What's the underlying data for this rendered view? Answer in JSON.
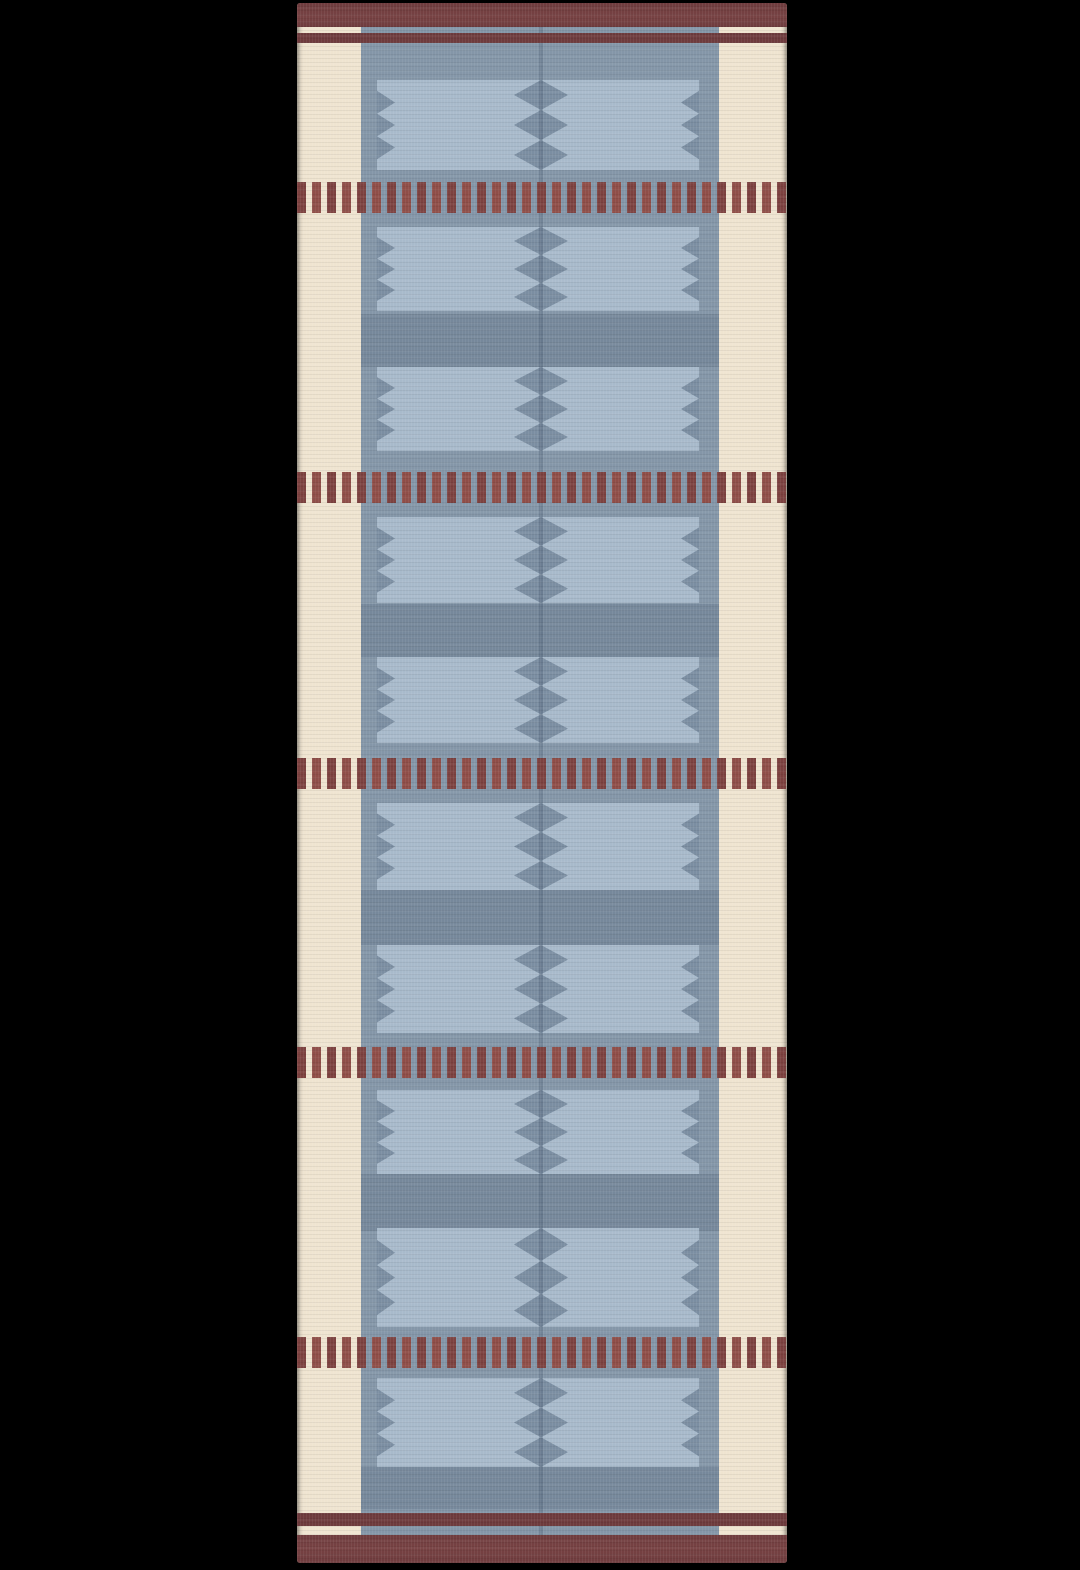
{
  "scene": {
    "description": "Product photo of a flat-woven kilim-style runner rug, shown full-length on a black background. The rug has cream side borders, a slate-blue centre field filled with light-blue flag motifs that have zigzag edges and a centre chain of dark diamonds, horizontal rows of maroon dashes, thin maroon stripes and solid maroon bands at both ends.",
    "background_color": "#000000"
  },
  "rug": {
    "left": 297,
    "top": 3,
    "width": 490,
    "height": 1560,
    "colors": {
      "cream": "#efe4d0",
      "panel_blue": "#8496a8",
      "flag_blue": "#a8bacb",
      "teeth_blue": "#7b8ea2",
      "gap_blue": "#76889b",
      "band_maroon": "#6f3c3e",
      "band_maroon_light": "#774243",
      "stripe_maroon": "#6e3b3d",
      "dash_maroon_a": "#7d4240",
      "dash_maroon_b": "#8f4e48",
      "seam_shadow": "rgba(52,70,90,0.22)"
    },
    "layout": {
      "panel": {
        "left": 64,
        "width": 358,
        "top": 24,
        "bottom": 1532
      },
      "top_band": {
        "y": 0,
        "h": 24
      },
      "top_stripe": {
        "y": 30,
        "h": 10
      },
      "bottom_stripe": {
        "y": 1510,
        "h": 13
      },
      "bottom_band": {
        "y": 1532,
        "h": 28
      },
      "dash_rows": {
        "ys": [
          179,
          469,
          755,
          1044,
          1334
        ],
        "h": 31,
        "dash_w": 9,
        "gap_w": 6,
        "alt_period": 30
      },
      "flags_region": {
        "left": 80,
        "width": 322,
        "seam_center": 244,
        "tooth_depth": 18,
        "diamond_half_width": 27
      },
      "flag_rows": [
        {
          "y": 77,
          "h": 90
        },
        {
          "y": 224,
          "h": 84
        },
        {
          "y": 364,
          "h": 84
        },
        {
          "y": 514,
          "h": 86
        },
        {
          "y": 654,
          "h": 86
        },
        {
          "y": 800,
          "h": 87
        },
        {
          "y": 942,
          "h": 88
        },
        {
          "y": 1087,
          "h": 84
        },
        {
          "y": 1225,
          "h": 99
        },
        {
          "y": 1375,
          "h": 89
        }
      ],
      "gap_bands": [
        {
          "y": 311,
          "h": 53
        },
        {
          "y": 601,
          "h": 53
        },
        {
          "y": 887,
          "h": 55
        },
        {
          "y": 1171,
          "h": 57
        },
        {
          "y": 1464,
          "h": 42
        }
      ]
    }
  }
}
